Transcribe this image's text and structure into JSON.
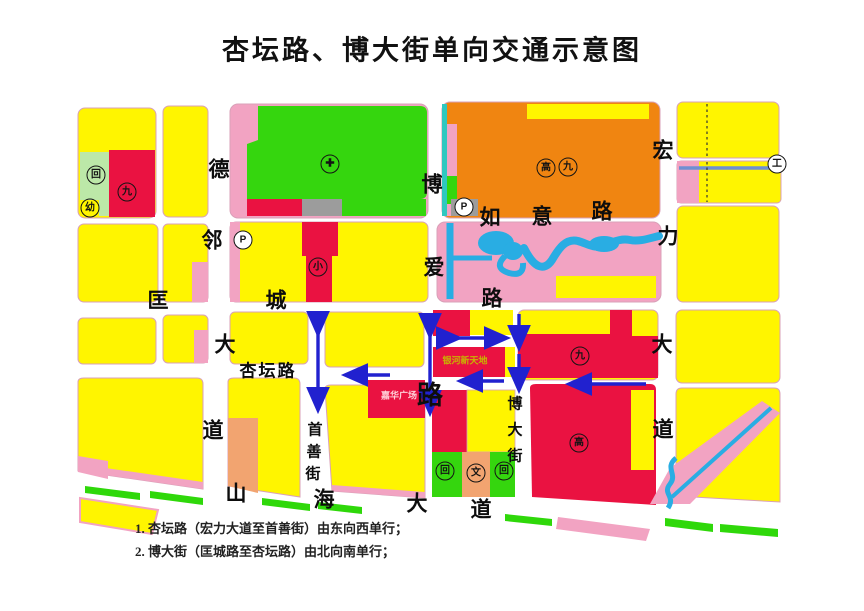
{
  "title": "杏坛路、博大街单向交通示意图",
  "notes": {
    "line1": "1. 杏坛路（宏力大道至首善街）由东向西单行；",
    "line2": "2. 博大街（匡城路至杏坛路）由北向南单行；"
  },
  "roads": {
    "delin_dadao": {
      "c1": "德",
      "c2": "邻",
      "c3": "大",
      "c4": "道"
    },
    "kuangcheng_lu": {
      "c1": "匡",
      "c2": "城",
      "c3": "路"
    },
    "ruyi_lu": {
      "c1": "如",
      "c2": "意",
      "c3": "路"
    },
    "boai_lu": {
      "c1": "博",
      "c2": "爱",
      "c3": "路"
    },
    "hongli_dadao": {
      "c1": "宏",
      "c2": "力",
      "c3": "大",
      "c4": "道"
    },
    "xingtan_lu": {
      "name": "杏坛路"
    },
    "boda_jie": {
      "c1": "博",
      "c2": "大",
      "c3": "街"
    },
    "shoushan_jie": {
      "c1": "首",
      "c2": "善",
      "c3": "街"
    },
    "shanhai_dadao": {
      "c1": "山",
      "c2": "海",
      "c3": "大",
      "c4": "道"
    }
  },
  "facilities": {
    "hui_nw": "回",
    "jiu_nw": "九",
    "you_nw": "幼",
    "hospital_cross": "✚",
    "gao_ne": "高",
    "jiu_ne": "九",
    "parking_ne": "P",
    "parking_w": "P",
    "xiao_mid": "小",
    "jiu_e": "九",
    "gao_se": "高",
    "hui_s1": "回",
    "wen_s": "文",
    "hui_s2": "回",
    "gong_far_ne": "工"
  },
  "places": {
    "yinhe": "银河新天地",
    "jiahua": "嘉华广场"
  },
  "colors": {
    "block_yellow": "#FFF500",
    "hospital_green": "#35D60E",
    "pale_green": "#BCE8A8",
    "school_orange": "#F08511",
    "block_red": "#EA1241",
    "pink": "#F2A3C2",
    "salmon": "#F2A470",
    "water_blue": "#29ADE3",
    "arrow_blue": "#2121CF",
    "gray": "#9C9C9C",
    "teal": "#2FC8C0"
  }
}
